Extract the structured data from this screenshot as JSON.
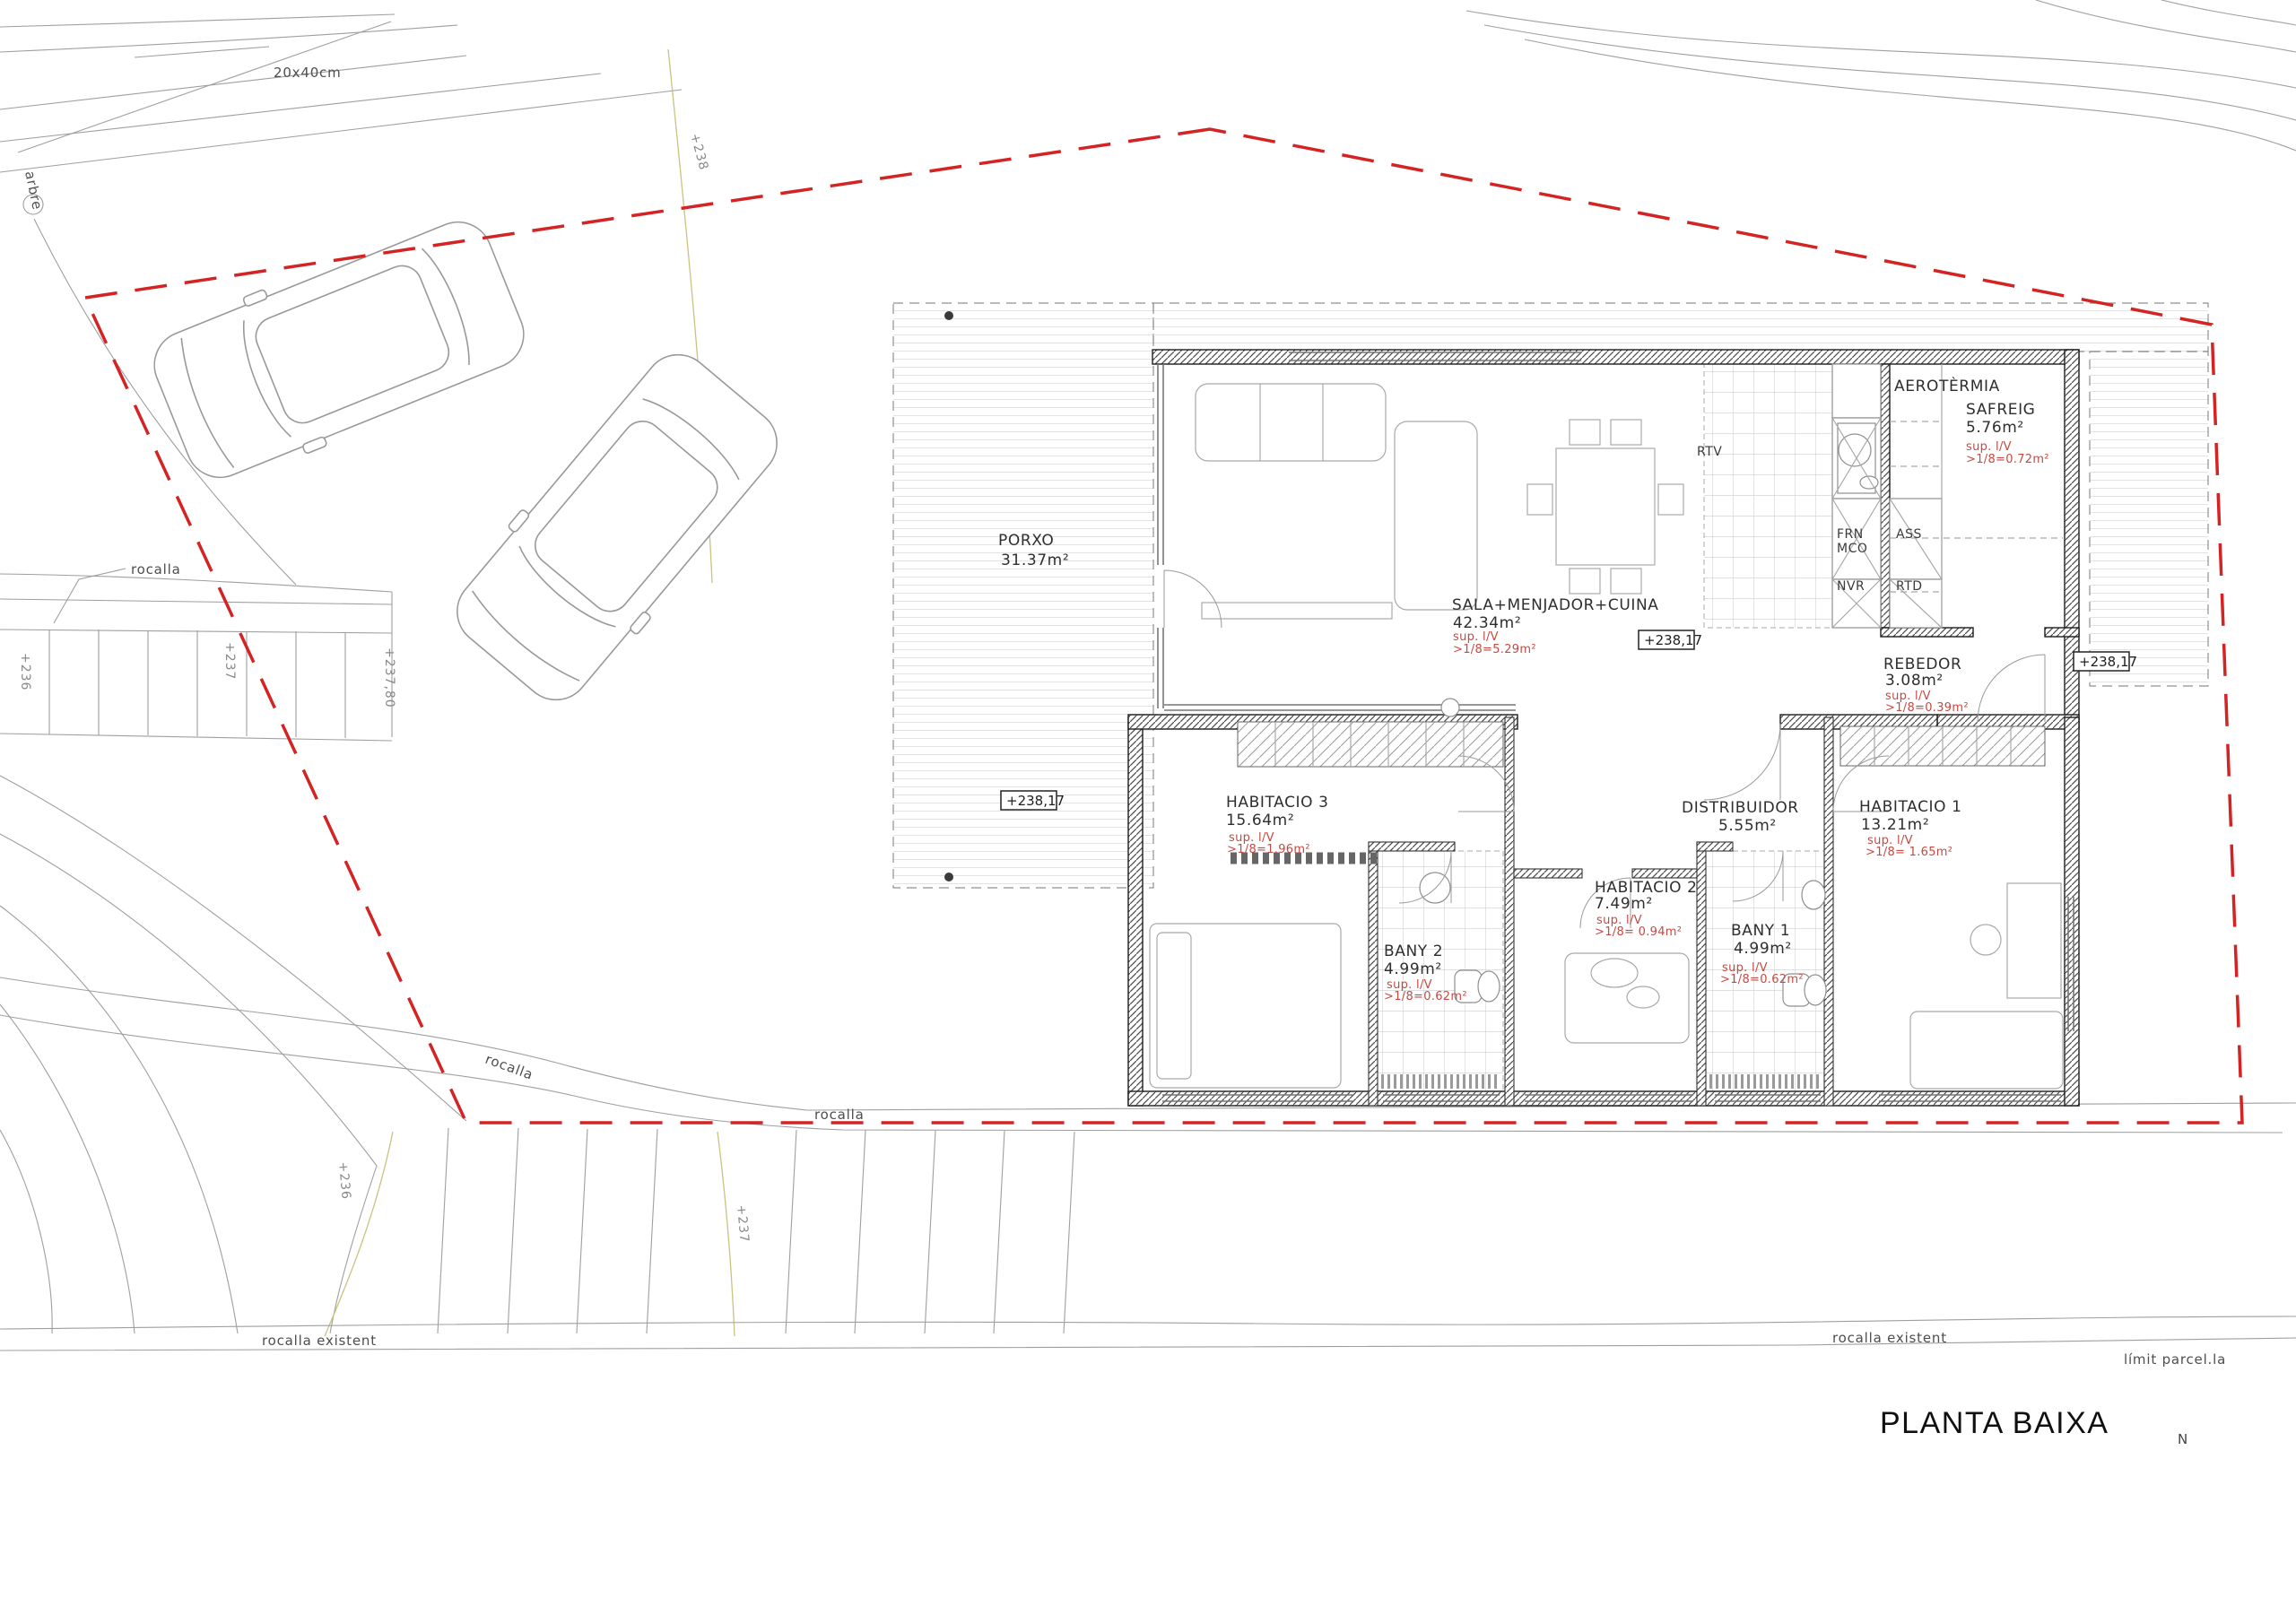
{
  "title": {
    "text": "PLANTA BAIXA",
    "north": "N"
  },
  "colors": {
    "boundary_red": "#d42323",
    "annotation_red": "#c64a42",
    "contour_olive": "#c9c37f",
    "line_grey": "#9f9f9f",
    "wall_black": "#1c1c1c"
  },
  "site": {
    "block_size": "20x40cm",
    "tree": "arbre",
    "rocalla_leader": "rocalla",
    "rocalla_slope_1": "rocalla",
    "rocalla_slope_2": "rocalla",
    "rocalla_existent_left": "rocalla existent",
    "rocalla_existent_right": "rocalla existent",
    "limit_parcella": "límit parcel.la",
    "contours": {
      "stairs_236": "+236",
      "stairs_237": "+237",
      "stairs_23780": "+237,80",
      "upper_238": "+238",
      "slope_236": "+236",
      "slope_237": "+237"
    }
  },
  "floor": {
    "level_markers": {
      "porch": "+238,17",
      "kitchen": "+238,17",
      "entry": "+238,17"
    },
    "rooms": [
      {
        "name": "PORXO",
        "area": "31.37m²"
      },
      {
        "name": "SALA+MENJADOR+CUINA",
        "area": "42.34m²",
        "sup1": "sup. l/V",
        "sup2": ">1/8=5.29m²"
      },
      {
        "name": "SAFREIG",
        "area": "5.76m²",
        "sup1": "sup. l/V",
        "sup2": ">1/8=0.72m²"
      },
      {
        "name": "AEROTÈRMIA"
      },
      {
        "name": "REBEDOR",
        "area": "3.08m²",
        "sup1": "sup. l/V",
        "sup2": ">1/8=0.39m²"
      },
      {
        "name": "HABITACIO 3",
        "area": "15.64m²",
        "sup1": "sup. l/V",
        "sup2": ">1/8=1.96m²"
      },
      {
        "name": "BANY 2",
        "area": "4.99m²",
        "sup1": "sup. l/V",
        "sup2": ">1/8=0.62m²"
      },
      {
        "name": "HABITACIO 2",
        "area": "7.49m²",
        "sup1": "sup. l/V",
        "sup2": ">1/8= 0.94m²"
      },
      {
        "name": "DISTRIBUIDOR",
        "area": "5.55m²"
      },
      {
        "name": "BANY 1",
        "area": "4.99m²",
        "sup1": "sup. l/V",
        "sup2": ">1/8=0.62m²"
      },
      {
        "name": "HABITACIO 1",
        "area": "13.21m²",
        "sup1": "sup. l/V",
        "sup2": ">1/8= 1.65m²"
      }
    ],
    "kitchen_labels": {
      "rtv": "RTV",
      "frn": "FRN",
      "mco": "MCO",
      "nvr": "NVR",
      "ass": "ASS",
      "rtd": "RTD"
    }
  }
}
